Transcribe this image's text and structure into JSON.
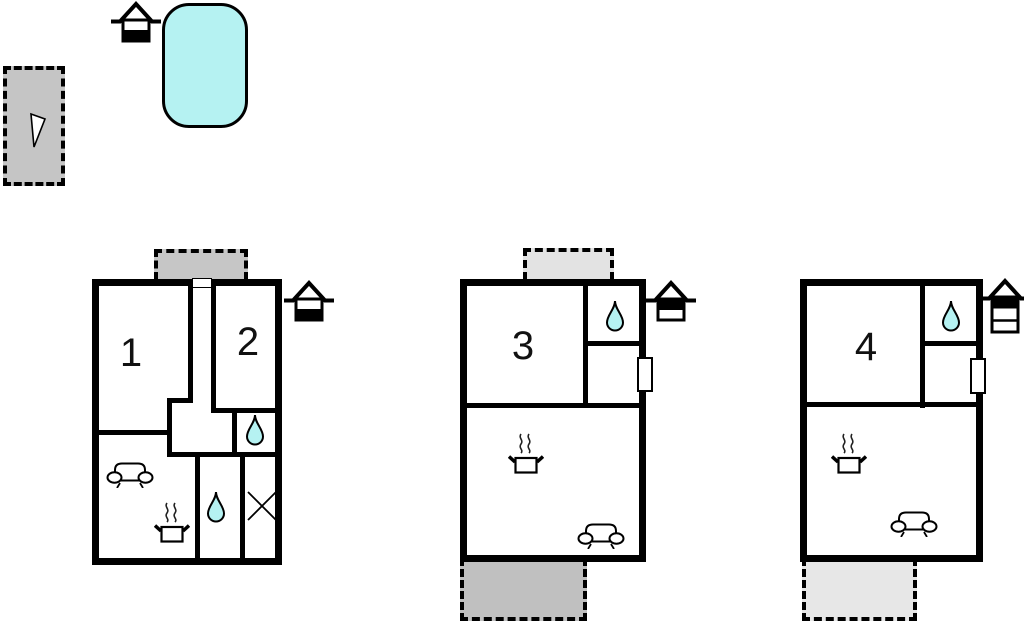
{
  "diagram_type": "holiday-home-floor-plans",
  "colors": {
    "wall": "#000000",
    "pool_fill": "#b5f2f2",
    "drop_fill": "#b5f2f2",
    "parking_fill": "#c5c5c5",
    "terrace_1": "#c6c6c6",
    "terrace_2_top": "#e3e3e3",
    "terrace_2_bottom": "#c0c0c0",
    "terrace_3_bottom": "#e7e7e7"
  },
  "site": {
    "parking": {
      "icon": "direction-arrow"
    },
    "pool": {
      "icon": "swimming-pool"
    },
    "pool_house": {
      "icon": "house-ground-floor"
    }
  },
  "plans": [
    {
      "name": "unit-1-2",
      "room_labels": [
        "1",
        "2"
      ],
      "floor_icon": "house-ground-floor",
      "icons": [
        "terrace-top",
        "sofa",
        "stove",
        "water-drop",
        "water-drop",
        "x-mark",
        "door-opening"
      ]
    },
    {
      "name": "unit-3",
      "room_labels": [
        "3"
      ],
      "floor_icon": "house-upper-floor",
      "icons": [
        "terrace-top",
        "terrace-bottom",
        "water-drop",
        "stove",
        "sofa",
        "door-opening"
      ]
    },
    {
      "name": "unit-4",
      "room_labels": [
        "4"
      ],
      "floor_icon": "house-top-floor-three-storey",
      "icons": [
        "terrace-bottom",
        "water-drop",
        "stove",
        "sofa",
        "door-opening"
      ]
    }
  ]
}
